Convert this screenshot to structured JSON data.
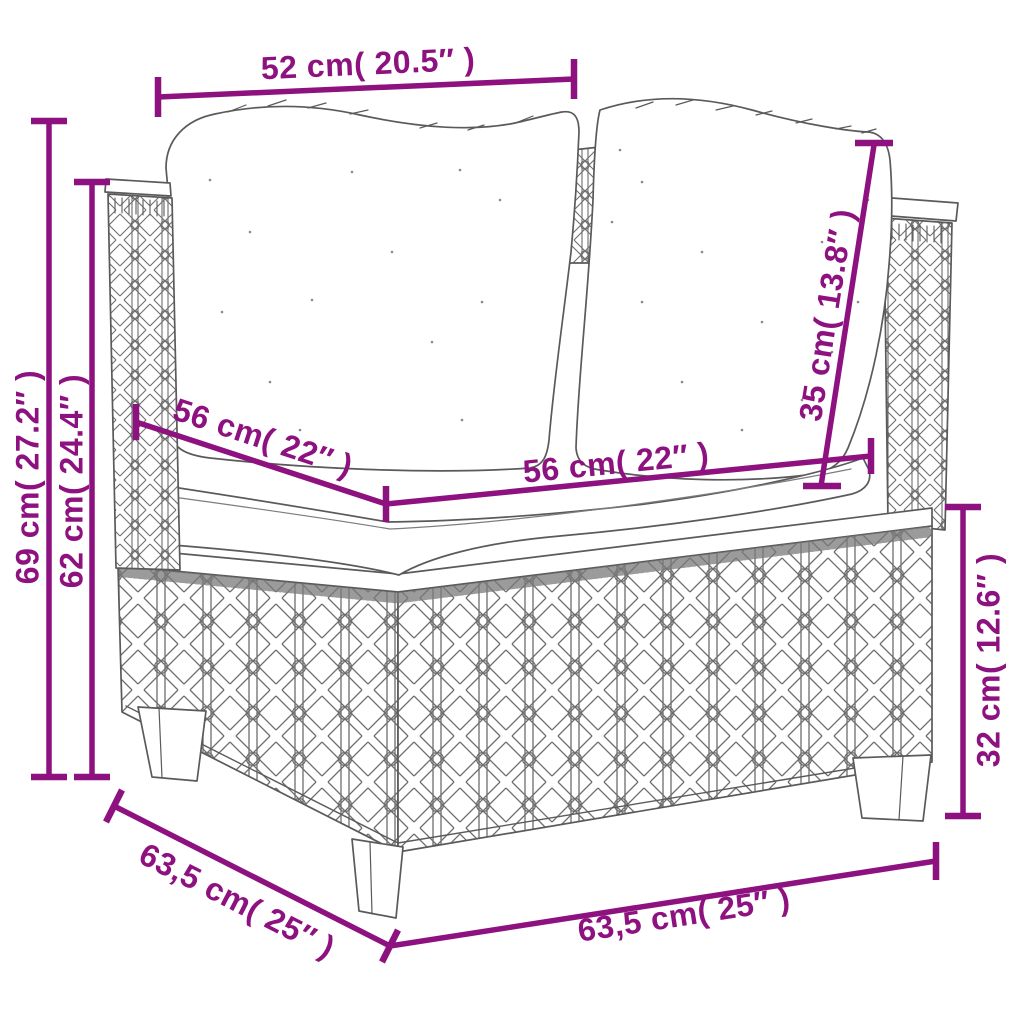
{
  "diagram_type": "furniture-dimension-drawing",
  "colors": {
    "dimension_accent": "#8E1180",
    "line_art": "#5a5a5a",
    "background": "#ffffff"
  },
  "dimensions": {
    "top_width": {
      "label": "52 cm( 20.5″ )"
    },
    "overall_height": {
      "label": "69 cm( 27.2″ )"
    },
    "arm_height": {
      "label": "62 cm( 24.4″ )"
    },
    "seat_depth": {
      "label": "56 cm( 22″ )"
    },
    "seat_width": {
      "label": "56 cm( 22″ )"
    },
    "back_cushion_height": {
      "label": "35 cm( 13.8″ )"
    },
    "base_height": {
      "label": "32 cm( 12.6″ )"
    },
    "base_depth": {
      "label": "63,5 cm( 25″ )"
    },
    "base_width": {
      "label": "63,5 cm( 25″ )"
    }
  }
}
